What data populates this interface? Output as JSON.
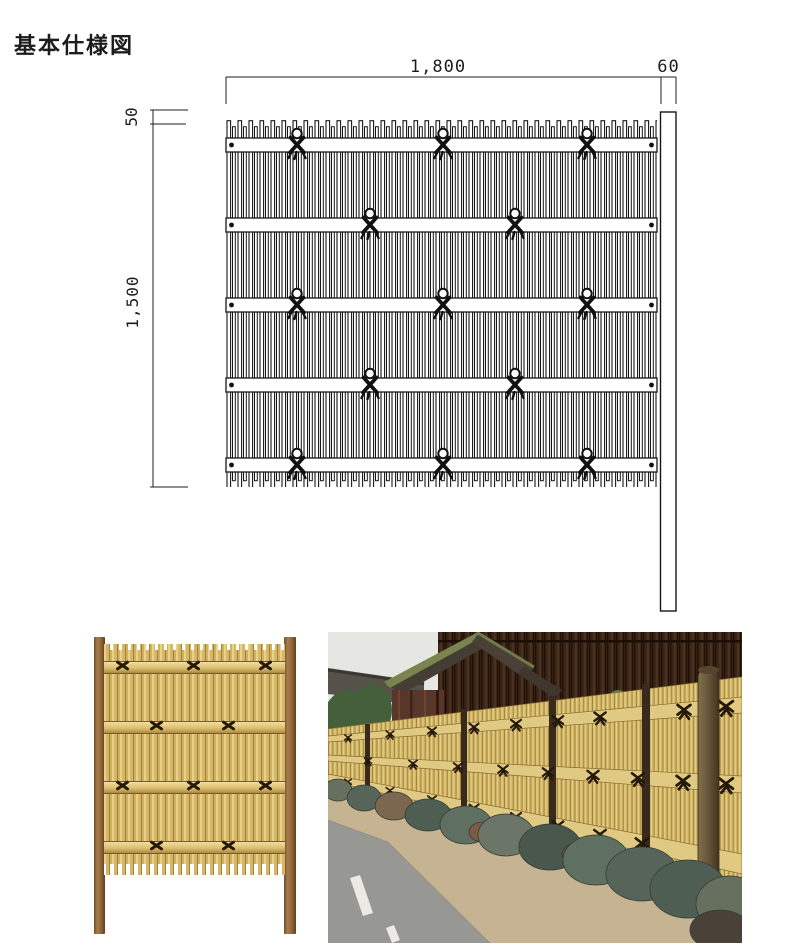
{
  "title": "基本仕様図",
  "drawing": {
    "dim_width_label": "1,800",
    "dim_post_label": "60",
    "dim_top_label": "50",
    "dim_height_label": "1,500",
    "line_color": "#1c1c1c",
    "background": "#ffffff",
    "rail_count": 5,
    "knot_columns_odd_rails": 3,
    "knot_columns_even_rails": 2
  },
  "photos": {
    "product": {
      "description_name": "bamboo-fence-panel-product-shot",
      "bamboo_color": "#d5b766",
      "rail_color": "#dcbe6e",
      "post_color": "#8f6638",
      "knot_color": "#241806",
      "rail_count": 4
    },
    "installation": {
      "description_name": "bamboo-fence-street-installation-photo",
      "bamboo_color": "#d2b664",
      "rail_color": "#e0ca83",
      "post_color": "#382a1c",
      "wall_color": "#3a2516",
      "stone_color": "#5f6f62",
      "sand_color": "#c6b391",
      "road_color": "#979894",
      "sky_color": "#e6e6e2"
    }
  }
}
